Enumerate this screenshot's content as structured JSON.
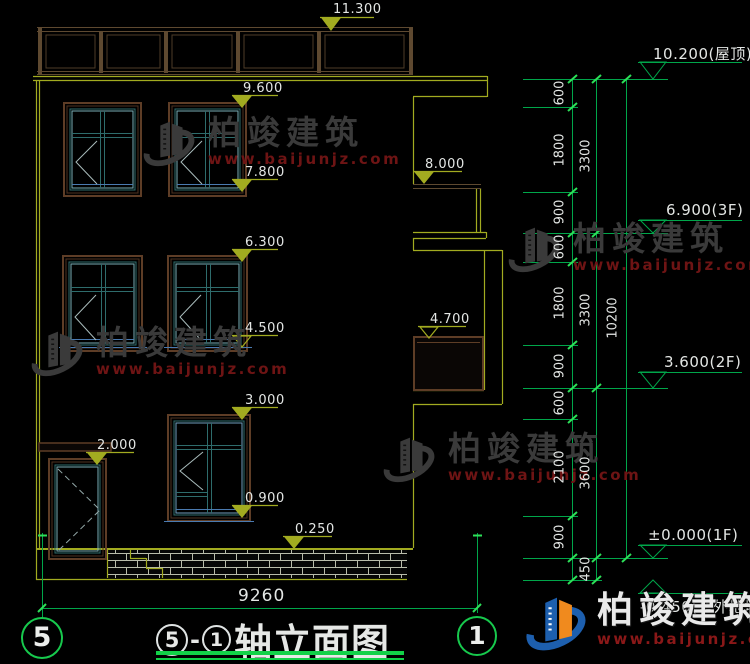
{
  "title": {
    "axis_from": "5",
    "separator": "-",
    "axis_to": "1",
    "text": "轴立面图"
  },
  "axis_bubbles": {
    "left": "5",
    "right": "1"
  },
  "bottom_dimension": "9260",
  "left_markers": [
    {
      "label": "11.300"
    },
    {
      "label": "9.600"
    },
    {
      "label": "7.800"
    },
    {
      "label": "8.000"
    },
    {
      "label": "6.300"
    },
    {
      "label": "4.500"
    },
    {
      "label": "4.700"
    },
    {
      "label": "3.000"
    },
    {
      "label": "2.000"
    },
    {
      "label": "0.900"
    },
    {
      "label": "0.250"
    }
  ],
  "right_markers": [
    {
      "label": "10.200(屋顶)"
    },
    {
      "label": "6.900(3F)"
    },
    {
      "label": "3.600(2F)"
    },
    {
      "label": "±0.000(1F)"
    },
    {
      "label": "-0.450(室外地坪)"
    }
  ],
  "chain": {
    "inner": [
      "600",
      "1800",
      "900",
      "600",
      "1800",
      "900",
      "600",
      "2100",
      "900"
    ],
    "middle": [
      "3300",
      "3300",
      "3600",
      "450"
    ],
    "overall": "10200"
  },
  "watermark": {
    "brand": "柏竣建筑",
    "site": "www.baijunjz.com"
  },
  "colors": {
    "cad_yellow": "#a2ab20",
    "cad_green": "#00a64a",
    "bright_green": "#2ce058",
    "frame_brown": "#5e3d26",
    "frame_teal": "#2e6c6c",
    "frame_cyan": "#78aeb6",
    "frame_blue": "#4a7ab0",
    "wm_gray": "#3a3a3a",
    "wm_red": "#6e1414",
    "logo_blue": "#1d5fae",
    "logo_orange": "#f08a1e"
  }
}
